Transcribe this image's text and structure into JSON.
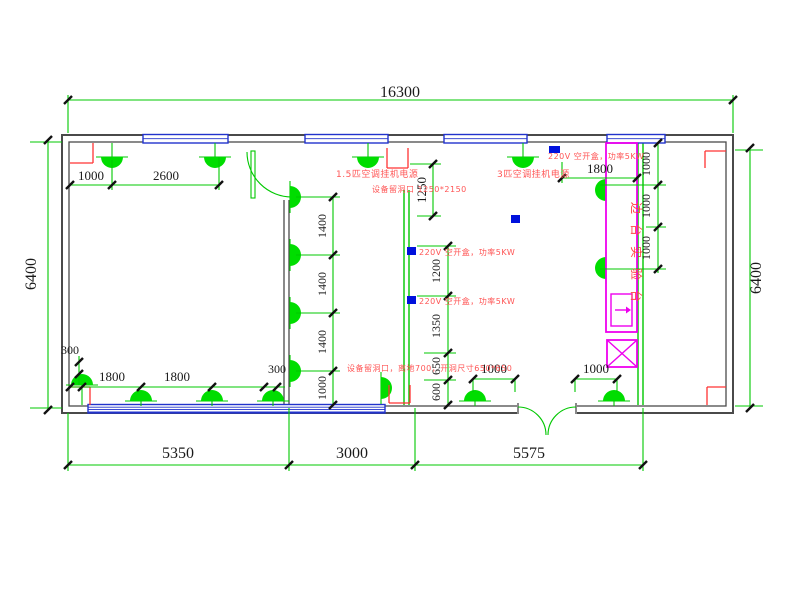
{
  "drawing_type": "electrical-floor-plan",
  "colors": {
    "dim_line": "#00c800",
    "lamp": "#00dd00",
    "wall": "#4a4a4a",
    "window": "#2233cc",
    "device_box": "#0011dd",
    "bench": "#ee00ee",
    "annotation": "#ff5555",
    "dim_text": "#1a1a1a"
  },
  "dims": {
    "overall_width": "16300",
    "height_left": "6400",
    "height_right": "6400",
    "bottom": [
      "5350",
      "3000",
      "5575"
    ],
    "top_left": [
      "1000",
      "2600"
    ],
    "top_right_1800": "1800",
    "right_chain": [
      "1000",
      "1000",
      "1000"
    ],
    "mid_chain": [
      "1400",
      "1400",
      "1400",
      "1000"
    ],
    "win_1250": "1250",
    "center_chain": [
      "1200",
      "1350",
      "650",
      "600"
    ],
    "bottom_left": [
      "300",
      "1800",
      "1800",
      "300"
    ],
    "bottom_center": [
      "1000",
      "1000"
    ]
  },
  "annotations": {
    "ac_15": "1.5匹空调挂机电源",
    "ac_3": "3匹空调挂机电源",
    "hole_top": "设备留洞口 1250*2150",
    "breaker_top": "220V 空开盒，功率5KW",
    "breaker_mid_1": "220V 空开盒，功率5KW",
    "breaker_mid_2": "220V 空开盒，功率5KW",
    "hole_bottom": "设备留洞口，离地700，开洞尺寸650*650",
    "bench_label": "边台实验台"
  }
}
